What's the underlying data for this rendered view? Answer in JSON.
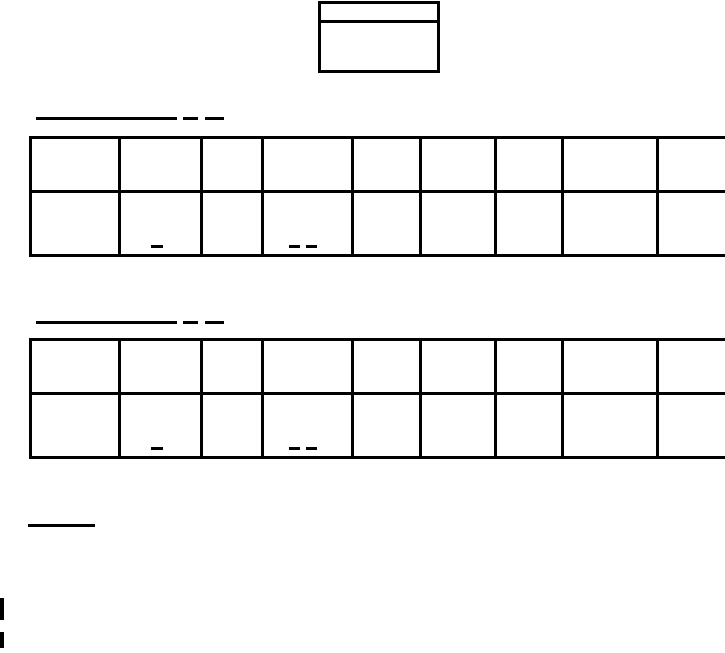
{
  "document": {
    "background_color": "#ffffff",
    "ink_color": "#000000",
    "header_box": {
      "rows": 2,
      "row_texts": [
        "",
        ""
      ]
    },
    "sections": [
      {
        "name": "section-1",
        "heading_rule": {
          "segments": [
            "long-underline",
            "short-dash",
            "short-dash"
          ],
          "text": ""
        },
        "table": {
          "columns": 9,
          "rows": 2,
          "bold_left_columns": [
            4,
            8
          ],
          "cells": [
            [
              "",
              "",
              "",
              "",
              "",
              "",
              "",
              "",
              ""
            ],
            [
              "",
              "",
              "",
              "",
              "",
              "",
              "",
              "",
              ""
            ]
          ],
          "marks": [
            {
              "row": 2,
              "col": 2,
              "dashes": 1
            },
            {
              "row": 2,
              "col": 4,
              "dashes": 2
            }
          ]
        }
      },
      {
        "name": "section-2",
        "heading_rule": {
          "segments": [
            "long-underline",
            "short-dash",
            "short-dash"
          ],
          "text": ""
        },
        "table": {
          "columns": 9,
          "rows": 2,
          "bold_left_columns": [
            4,
            8
          ],
          "cells": [
            [
              "",
              "",
              "",
              "",
              "",
              "",
              "",
              "",
              ""
            ],
            [
              "",
              "",
              "",
              "",
              "",
              "",
              "",
              "",
              ""
            ]
          ],
          "marks": [
            {
              "row": 2,
              "col": 2,
              "dashes": 1
            },
            {
              "row": 2,
              "col": 4,
              "dashes": 2
            }
          ]
        }
      }
    ],
    "footer_rule": {
      "segments": [
        "short-underline"
      ],
      "text": ""
    },
    "edge_artifacts": {
      "count": 2
    }
  }
}
